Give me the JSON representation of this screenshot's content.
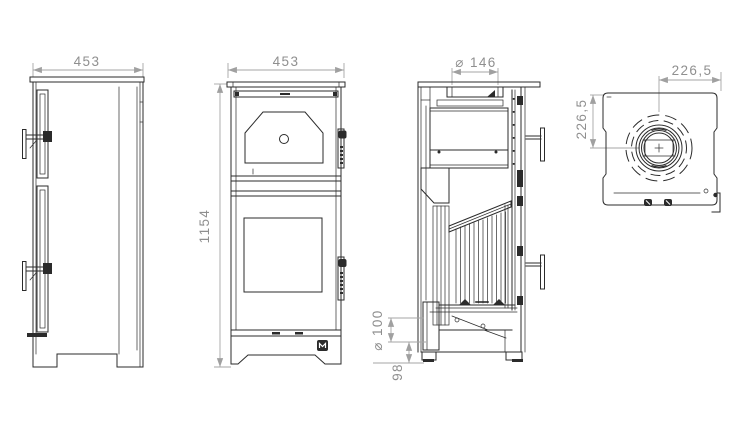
{
  "drawing": {
    "background_color": "#ffffff",
    "line_color": "#2b2b2b",
    "dimension_line_color": "#a6a6a6",
    "dimension_text_color": "#8f8f8f",
    "dimensions": {
      "side_width": "453",
      "front_width": "453",
      "front_height": "1154",
      "flue_diameter": "⌀ 146",
      "rear_outlet_diameter": "⌀ 100",
      "rear_outlet_height": "98",
      "top_center_x": "226,5",
      "top_center_y": "226,5"
    }
  }
}
